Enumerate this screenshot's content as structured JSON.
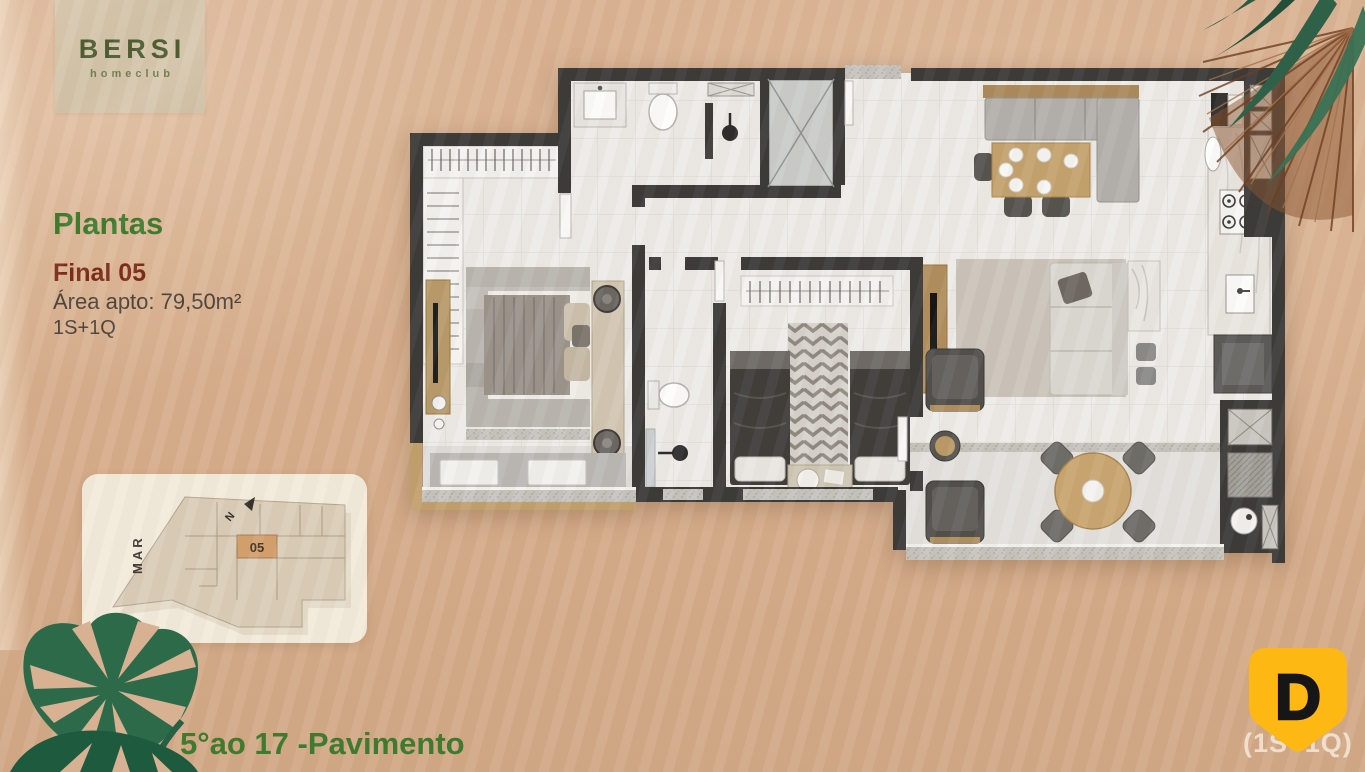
{
  "colors": {
    "background_sand": "#d7ae8c",
    "brand_green": "#3e7b2f",
    "accent_maroon": "#7c2a1a",
    "text_dark": "#4c443c",
    "logo_green": "#4c5c31",
    "badge_yellow": "#fdb813",
    "wall_dark": "#3b3a38",
    "minimap_card": "#f2ebdb",
    "minimap_unit_fill": "#d5a06e",
    "leaf_green": "#2c6a4a",
    "dried_palm_brown": "#8a5531"
  },
  "logo": {
    "title": "BERSI",
    "subtitle": "homeclub"
  },
  "info_panel": {
    "heading": "Plantas",
    "unit_label": "Final 05",
    "area_label": "Área apto: 79,50m²",
    "config_label": "1S+1Q"
  },
  "minimap": {
    "sea_label": "MAR",
    "north_label": "N",
    "unit_number": "05"
  },
  "footer": {
    "floors_label": "5°ao 17 -Pavimento",
    "watermark": "(1S+1Q)"
  },
  "badge": {
    "letter": "D"
  }
}
